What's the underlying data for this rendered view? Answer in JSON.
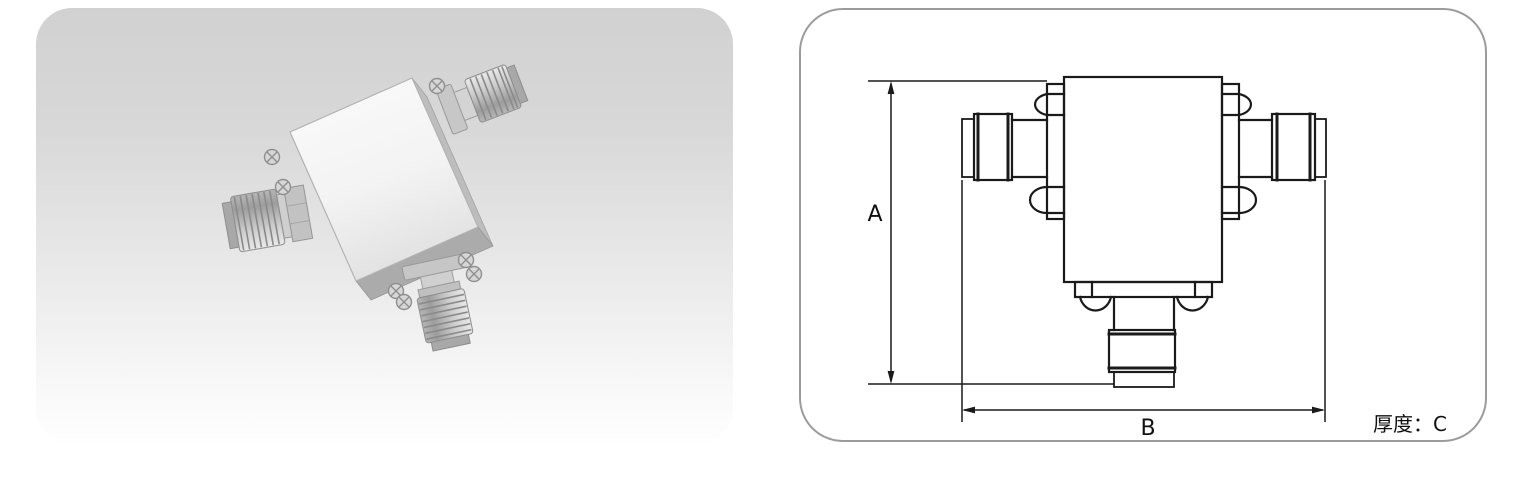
{
  "photo_panel": {
    "background_top": "#d1d1d1",
    "background_bottom": "#fdfdfd"
  },
  "drawing_panel": {
    "border_color": "#9b9b9b",
    "line_color": "#1a1a1a",
    "labels": {
      "height": "A",
      "width": "B",
      "thickness": "厚度：C"
    }
  }
}
